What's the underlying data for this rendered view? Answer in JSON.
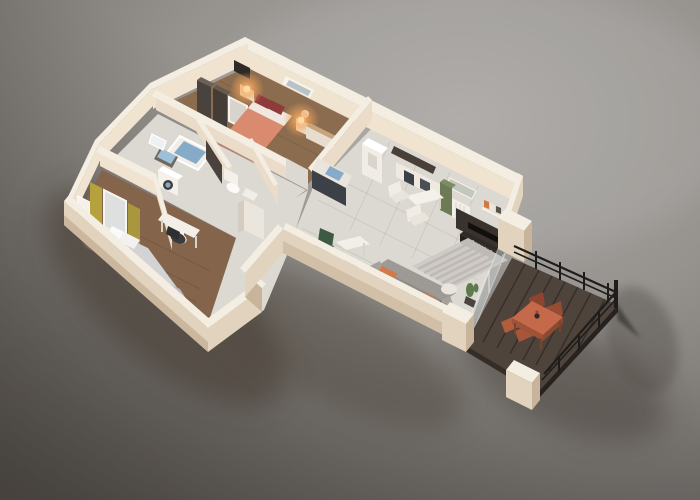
{
  "scene": {
    "type": "3d-floor-plan-render",
    "style": "isometric dollhouse cutaway of a one-storey apartment on a studio gray backdrop",
    "background": "neutral gray gradient with soft ground shadow toward lower-left",
    "lit_lamps_count": 4,
    "terrace_chairs_count": 4
  },
  "palette": {
    "bg_light": "#a9a6a3",
    "bg_mid": "#96938f",
    "bg_dark": "#66625f",
    "wall_top": "#f3ede2",
    "wall_inner_lit": "#f0e3d0",
    "wall_inner_dim": "#eadcc8",
    "wall_outer": "#e2d3bf",
    "wall_outer_dark": "#c8b49a",
    "floor_tile": "#dcd8d2",
    "floor_wood": "#8c6c4f",
    "floor_wood2": "#84644a",
    "furn_white": "#f2eee6",
    "deck": "#4e443b",
    "deck_gap": "#352d26",
    "bed_salmon": "#d98a6f",
    "pillow_red": "#8f3b3c",
    "bed2_gray": "#d3d3d5",
    "water_blue": "#85abc8",
    "cabinet_yellow": "#b5a23f",
    "wood_dark": "#4a423c",
    "sofa_gray": "#9d9a96",
    "accent_orange": "#d07a4a",
    "kitchen_dark": "#3c4147",
    "plant_green": "#5d7a4f",
    "terrace_table": "#c4694a",
    "terrace_chair": "#b05a3e",
    "railing_black": "#1f1d1b",
    "glow_warm": "#f5a351"
  },
  "rooms": [
    {
      "name": "master-bedroom",
      "floor": "wood",
      "furniture": [
        "salmon-double-bed",
        "dark-red-pillows",
        "nightstand-left",
        "nightstand-right",
        "lit-lamp-left",
        "lit-lamp-right",
        "dark-wardrobe",
        "leaning-mirror",
        "wall-tv",
        "dresser",
        "window"
      ]
    },
    {
      "name": "bathroom",
      "floor": "tile",
      "furniture": [
        "blue-bathtub",
        "blue-sink",
        "mirror",
        "washing-machine",
        "toilet",
        "dark-door"
      ]
    },
    {
      "name": "wc",
      "floor": "tile",
      "furniture": [
        "toilet",
        "small-sink"
      ]
    },
    {
      "name": "hallway",
      "floor": "tile",
      "furniture": [
        "tall-cabinet"
      ]
    },
    {
      "name": "bedroom-2",
      "floor": "wood",
      "furniture": [
        "gray-double-bed",
        "white-pillows",
        "nightstand-left",
        "nightstand-right",
        "lit-lamp-left",
        "lit-lamp-right",
        "yellow-wardrobe",
        "leaning-mirror",
        "desk",
        "desk-chair",
        "wall-frame"
      ]
    },
    {
      "name": "kitchen",
      "floor": "tile",
      "furniture": [
        "counter-dark-front",
        "blue-sink",
        "fridge",
        "dark-wall-niche",
        "appliance-row"
      ]
    },
    {
      "name": "living-dining",
      "floor": "tile",
      "furniture": [
        "white-table",
        "white-chairs",
        "small-table",
        "green-chairs",
        "striped-rug",
        "gray-sofa",
        "orange-throw",
        "orange-pillow",
        "round-pouf",
        "side-table-red-flowers",
        "cactus",
        "tv-console",
        "tv",
        "green-cabinet",
        "radiator",
        "wall-shelf-books",
        "window",
        "glass-door-to-terrace"
      ]
    },
    {
      "name": "terrace",
      "floor": "dark-decking",
      "furniture": [
        "terracotta-table",
        "terracotta-chairs",
        "table-vase",
        "black-railing",
        "cream-corner-pillars"
      ]
    }
  ]
}
